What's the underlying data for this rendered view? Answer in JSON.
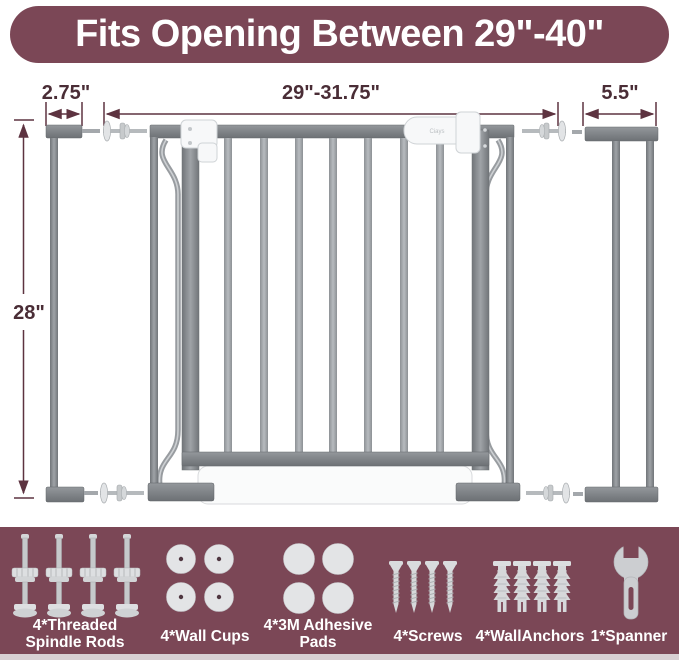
{
  "banner": {
    "title": "Fits Opening Between 29\"-40\""
  },
  "diagram": {
    "left_extension_width": "2.75\"",
    "gate_width": "29\"-31.75\"",
    "right_extension_width": "5.5\"",
    "gate_height": "28\"",
    "brand_logo": "Ciays"
  },
  "accessories": [
    {
      "name": "threaded-spindle-rods",
      "label_line1": "4*Threaded",
      "label_line2": "Spindle Rods"
    },
    {
      "name": "wall-cups",
      "label_line1": "4*Wall Cups"
    },
    {
      "name": "adhesive-pads",
      "label_line1": "4*3M Adhesive",
      "label_line2": "Pads"
    },
    {
      "name": "screws",
      "label_line1": "4*Screws"
    },
    {
      "name": "wall-anchors",
      "label_line1": "4*WallAnchors"
    },
    {
      "name": "spanner",
      "label_line1": "1*Spanner"
    }
  ],
  "colors": {
    "banner_bg": "#7b4756",
    "dimension_text": "#4a2d36",
    "dimension_line": "#5d3340",
    "metal_gray": "#8f9397",
    "white_part": "#f7f8f9",
    "icon_gray": "#dcdee0"
  }
}
